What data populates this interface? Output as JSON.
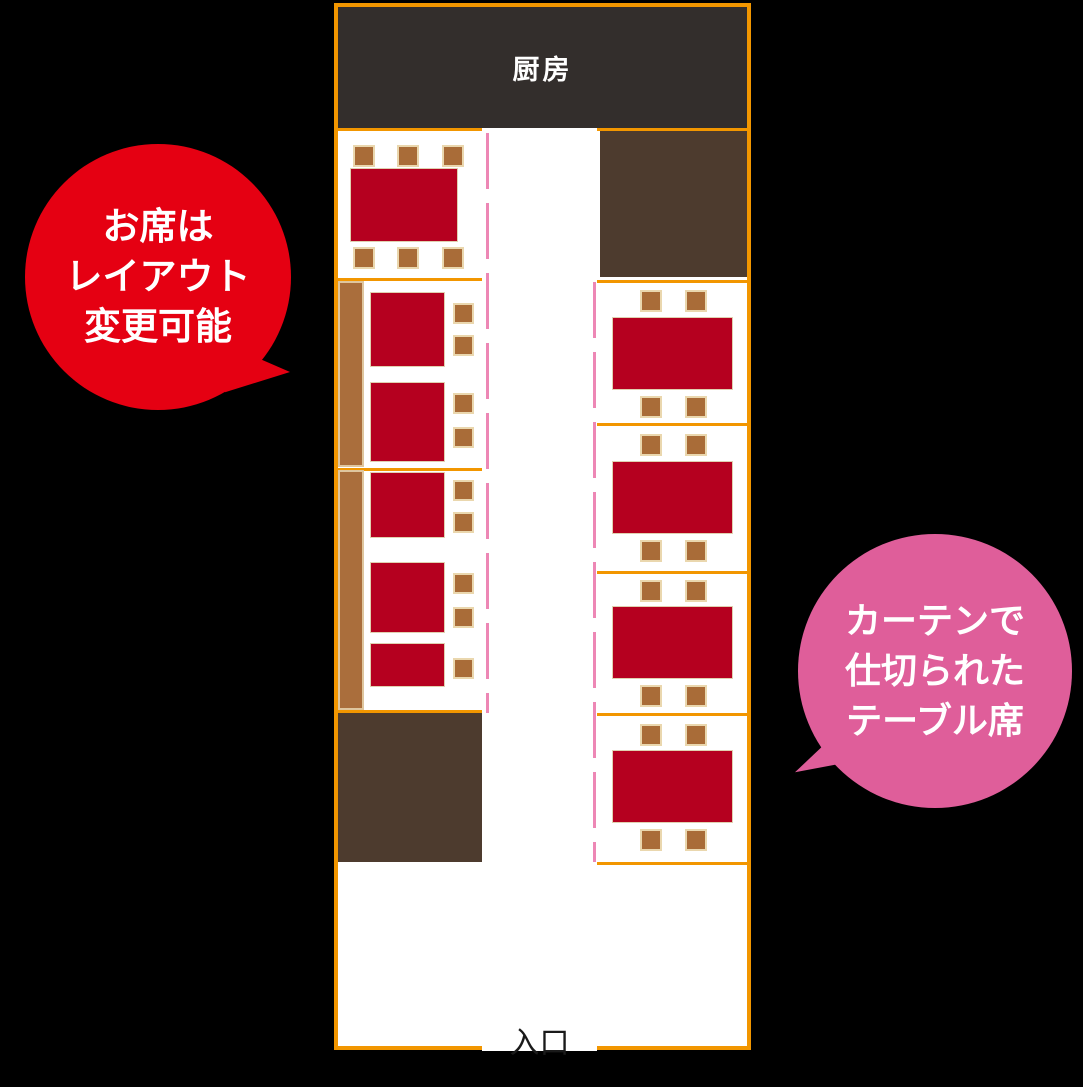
{
  "page": {
    "background": "#000000"
  },
  "floor_plan": {
    "kitchen": {
      "label": "厨房"
    },
    "entrance": {
      "label": "入口"
    },
    "colors": {
      "outline_orange": "#f29600",
      "kitchen_bg": "#332e2c",
      "kitchen_text": "#ffffff",
      "dark_area_brown": "#4d3b2e",
      "bench_brown": "#aa6e3c",
      "chair_brown": "#a96c38",
      "chair_border": "#ead7ae",
      "table_red": "#b5001f",
      "curtain_pink": "#ed87b5",
      "floor_white": "#ffffff",
      "entrance_text": "#1a1a1a"
    },
    "left_column": {
      "sections": [
        {
          "name": "six-seat-table",
          "tables": 1,
          "chairs": 6
        },
        {
          "name": "bench-tables-upper",
          "bench": true,
          "tables": 2,
          "chairs": 4
        },
        {
          "name": "bench-tables-lower",
          "bench": true,
          "tables": 3,
          "chairs": 5
        },
        {
          "name": "dark-area",
          "tables": 0,
          "chairs": 0
        }
      ]
    },
    "right_column": {
      "sections": [
        {
          "name": "dark-area",
          "tables": 0,
          "chairs": 0
        },
        {
          "name": "curtained-table-1",
          "tables": 1,
          "chairs": 4
        },
        {
          "name": "curtained-table-2",
          "tables": 1,
          "chairs": 4
        },
        {
          "name": "curtained-table-3",
          "tables": 1,
          "chairs": 4
        },
        {
          "name": "curtained-table-4",
          "tables": 1,
          "chairs": 4
        }
      ]
    }
  },
  "callouts": {
    "layout": {
      "color": "#e50012",
      "lines": [
        "お席は",
        "レイアウト",
        "変更可能"
      ]
    },
    "curtain": {
      "color": "#df5e9a",
      "lines": [
        "カーテンで",
        "仕切られた",
        "テーブル席"
      ]
    }
  }
}
